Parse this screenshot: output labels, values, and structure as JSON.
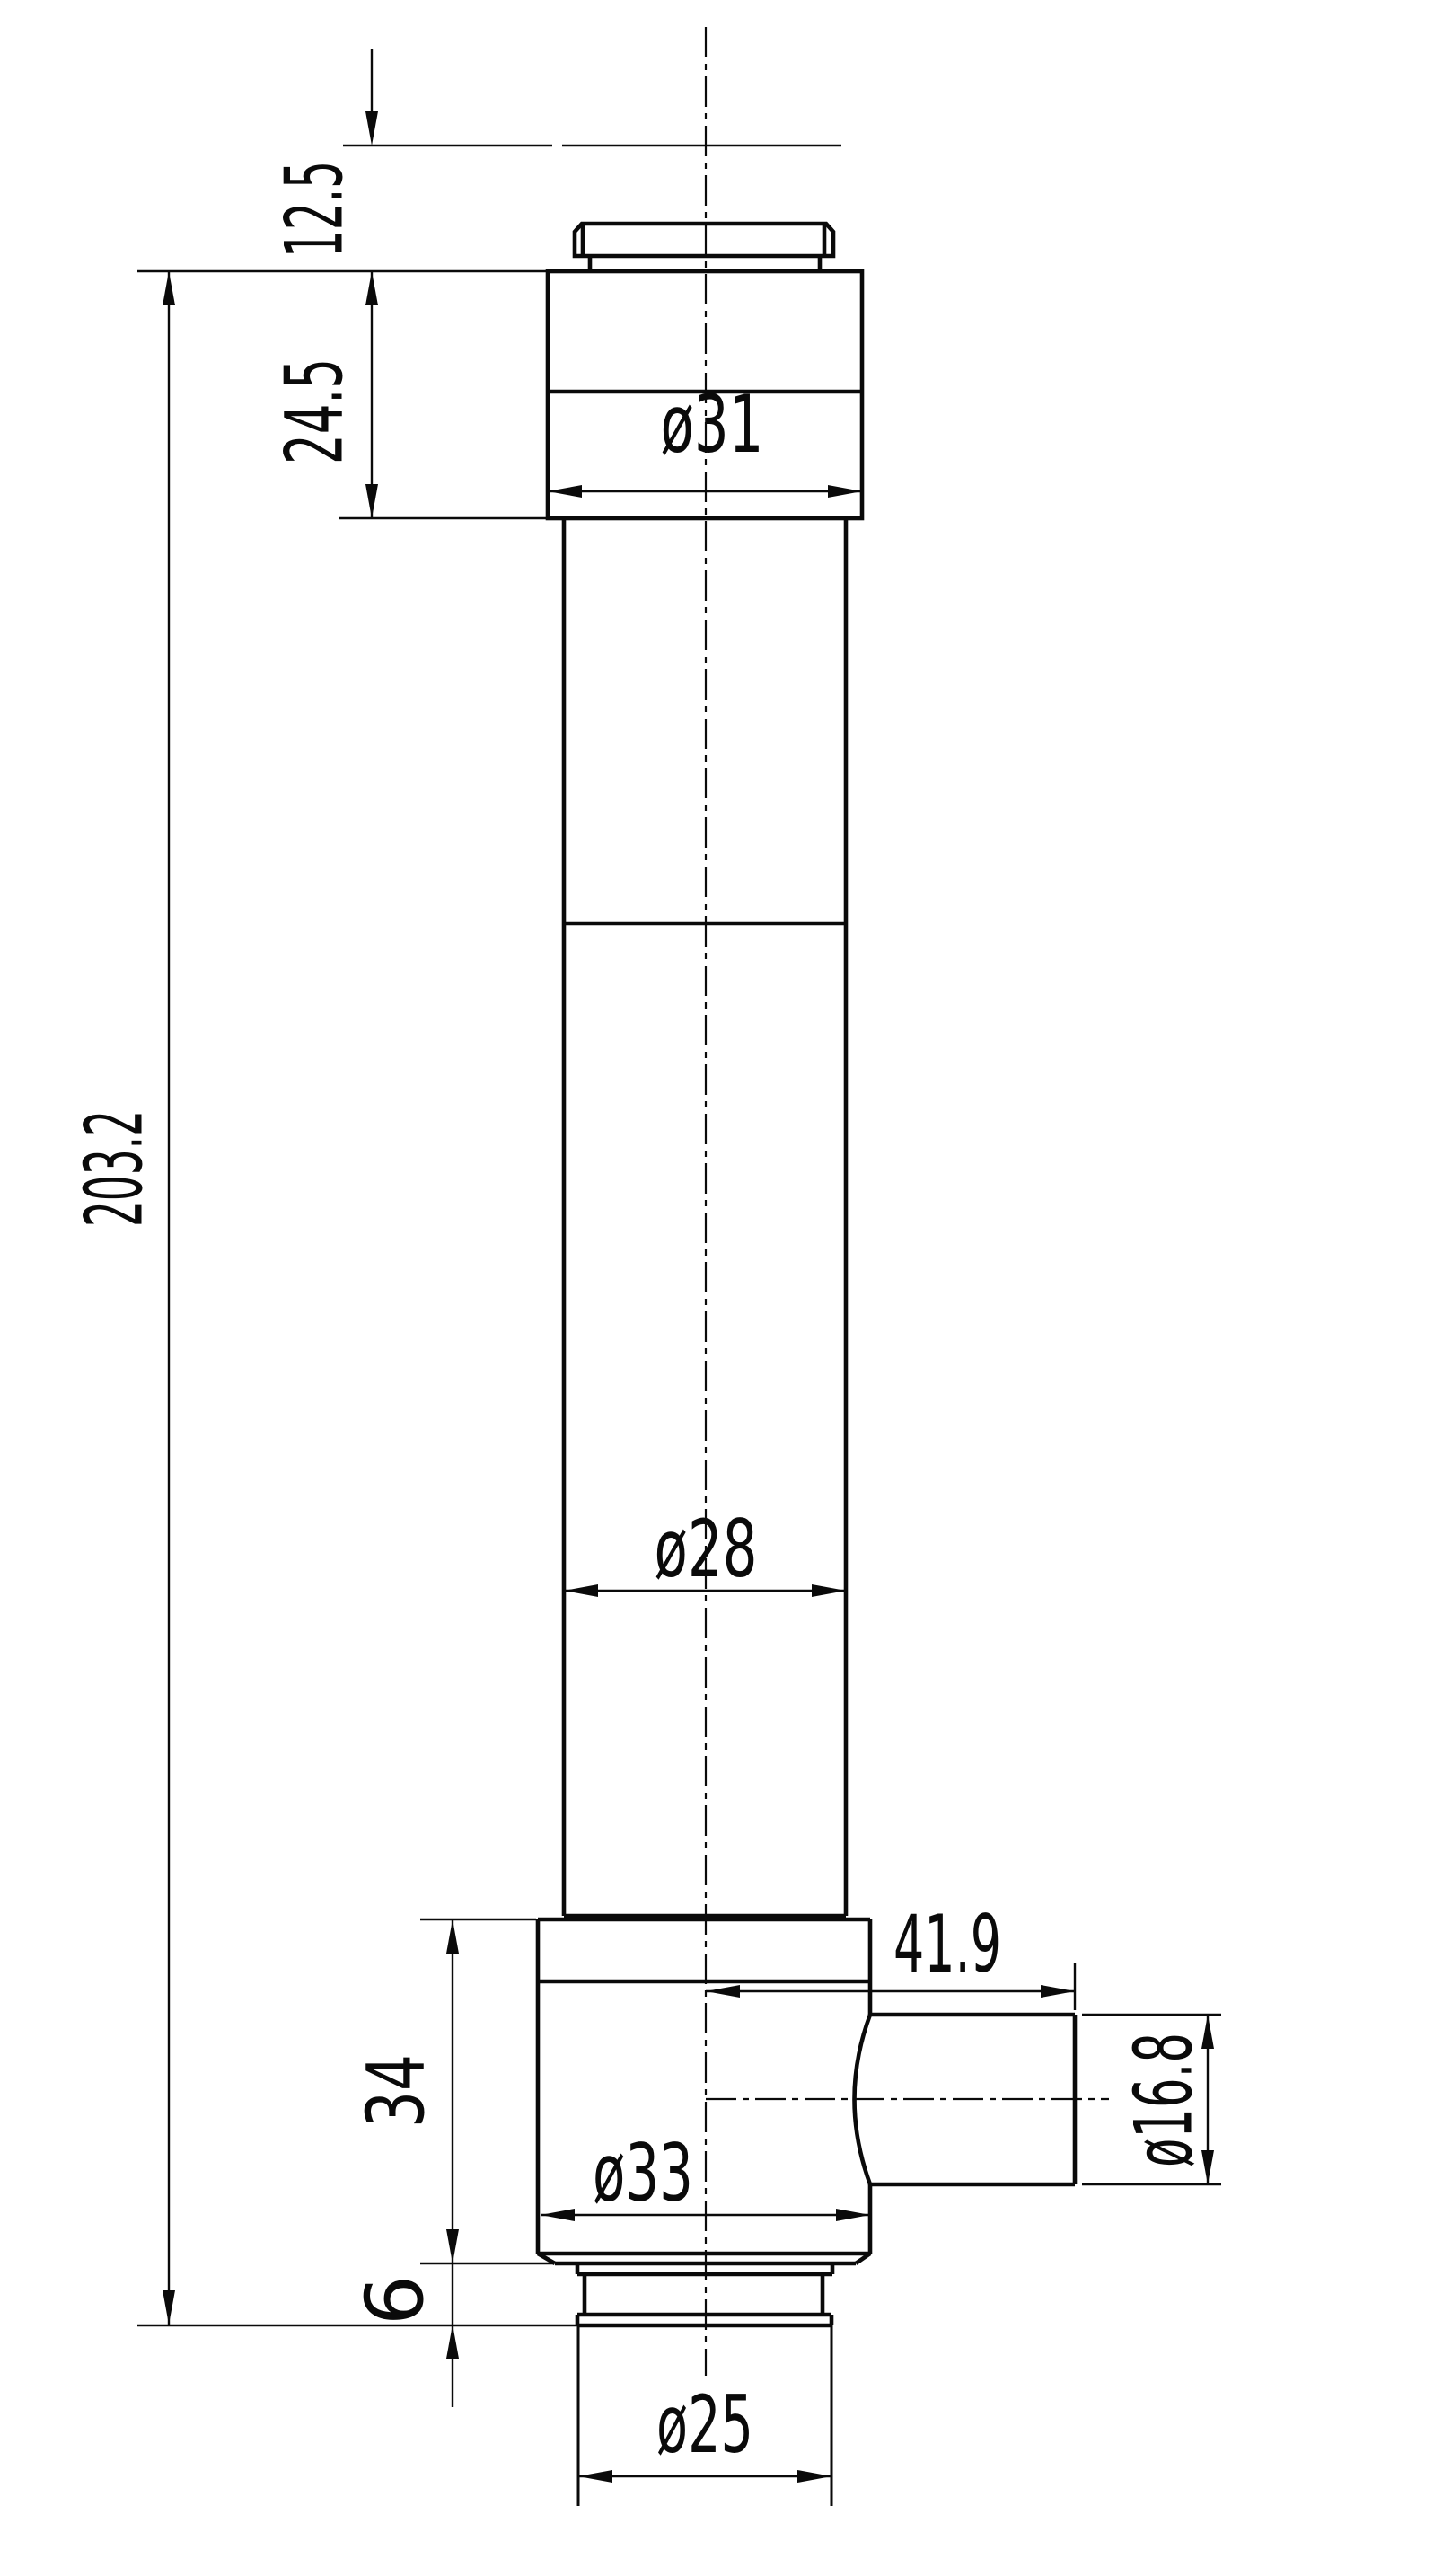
{
  "drawing": {
    "background_color": "#ffffff",
    "line_color": "#0a0a0a",
    "dimensions": {
      "eyecup_offset": {
        "label": "12.5",
        "orientation": "vertical"
      },
      "top_block_height": {
        "label": "24.5",
        "orientation": "vertical"
      },
      "overall_height": {
        "label": "203.2",
        "orientation": "vertical"
      },
      "top_block_diameter": {
        "label": "ø31",
        "orientation": "horizontal"
      },
      "tube_diameter": {
        "label": "ø28",
        "orientation": "horizontal"
      },
      "side_port_length": {
        "label": "41.9",
        "orientation": "horizontal"
      },
      "side_port_diameter": {
        "label": "ø16.8",
        "orientation": "vertical"
      },
      "bottom_block_height": {
        "label": "34",
        "orientation": "vertical"
      },
      "bottom_block_diameter": {
        "label": "ø33",
        "orientation": "horizontal"
      },
      "flange_height": {
        "label": "6",
        "orientation": "vertical"
      },
      "nose_diameter": {
        "label": "ø25",
        "orientation": "horizontal"
      }
    }
  }
}
